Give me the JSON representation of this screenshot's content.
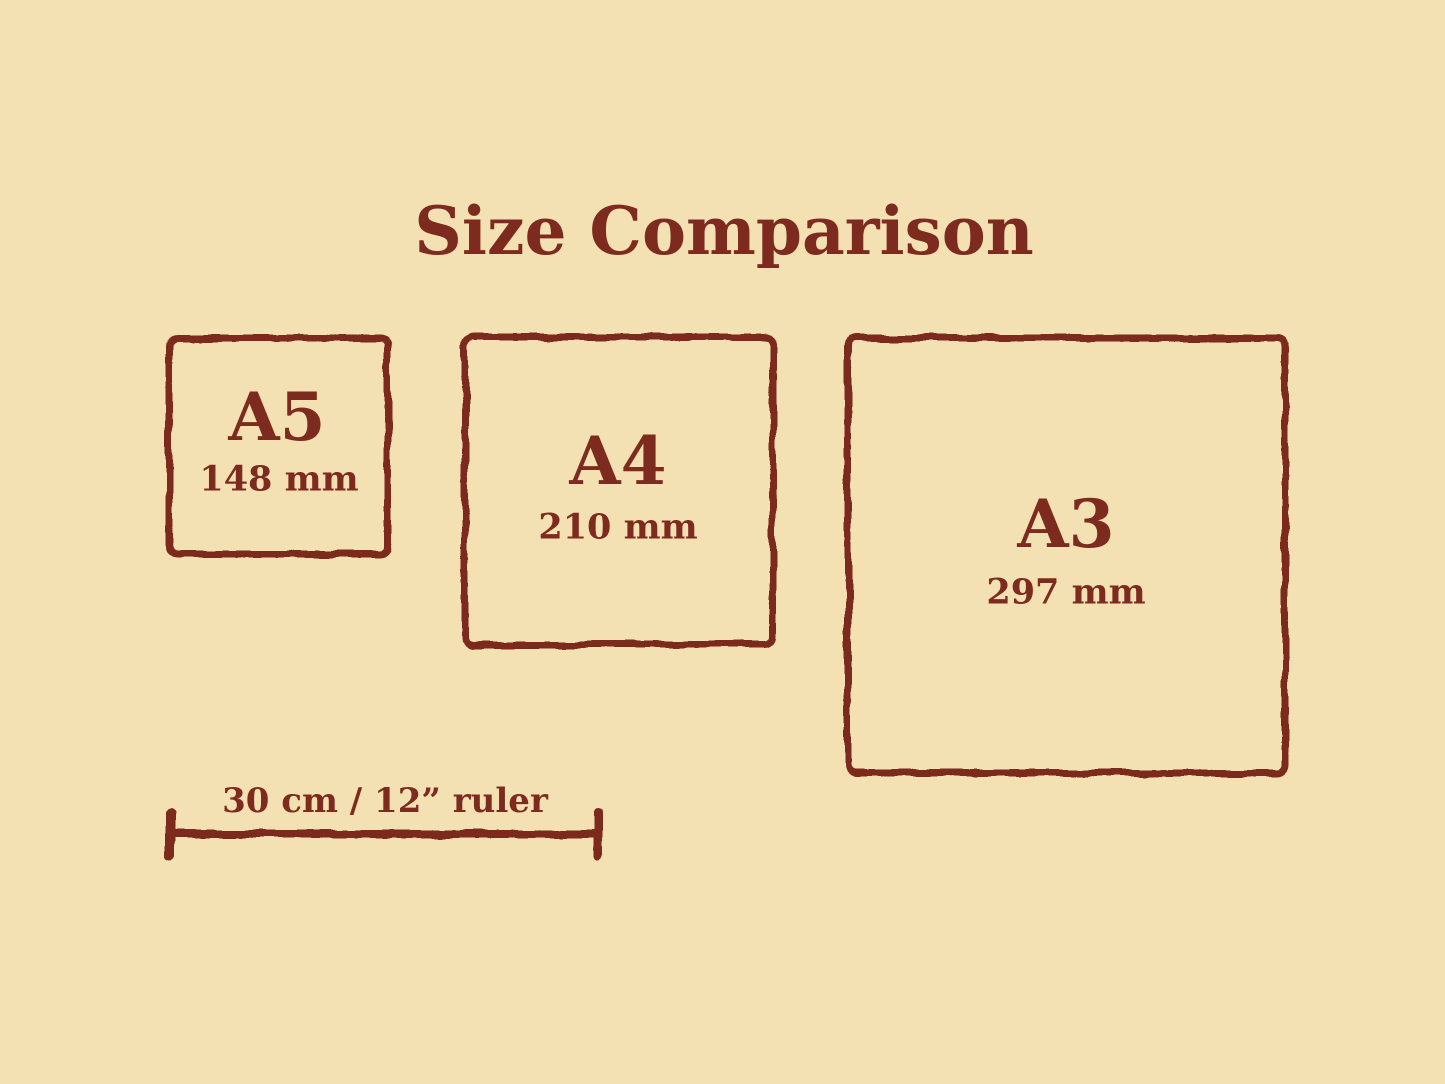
{
  "title": "Size Comparison",
  "colors": {
    "background": "#F3E0B3",
    "ink": "#7C2B1E"
  },
  "boxes": [
    {
      "code": "A5",
      "dimension": "148 mm"
    },
    {
      "code": "A4",
      "dimension": "210 mm"
    },
    {
      "code": "A3",
      "dimension": "297 mm"
    }
  ],
  "ruler": {
    "label": "30 cm / 12” ruler"
  }
}
